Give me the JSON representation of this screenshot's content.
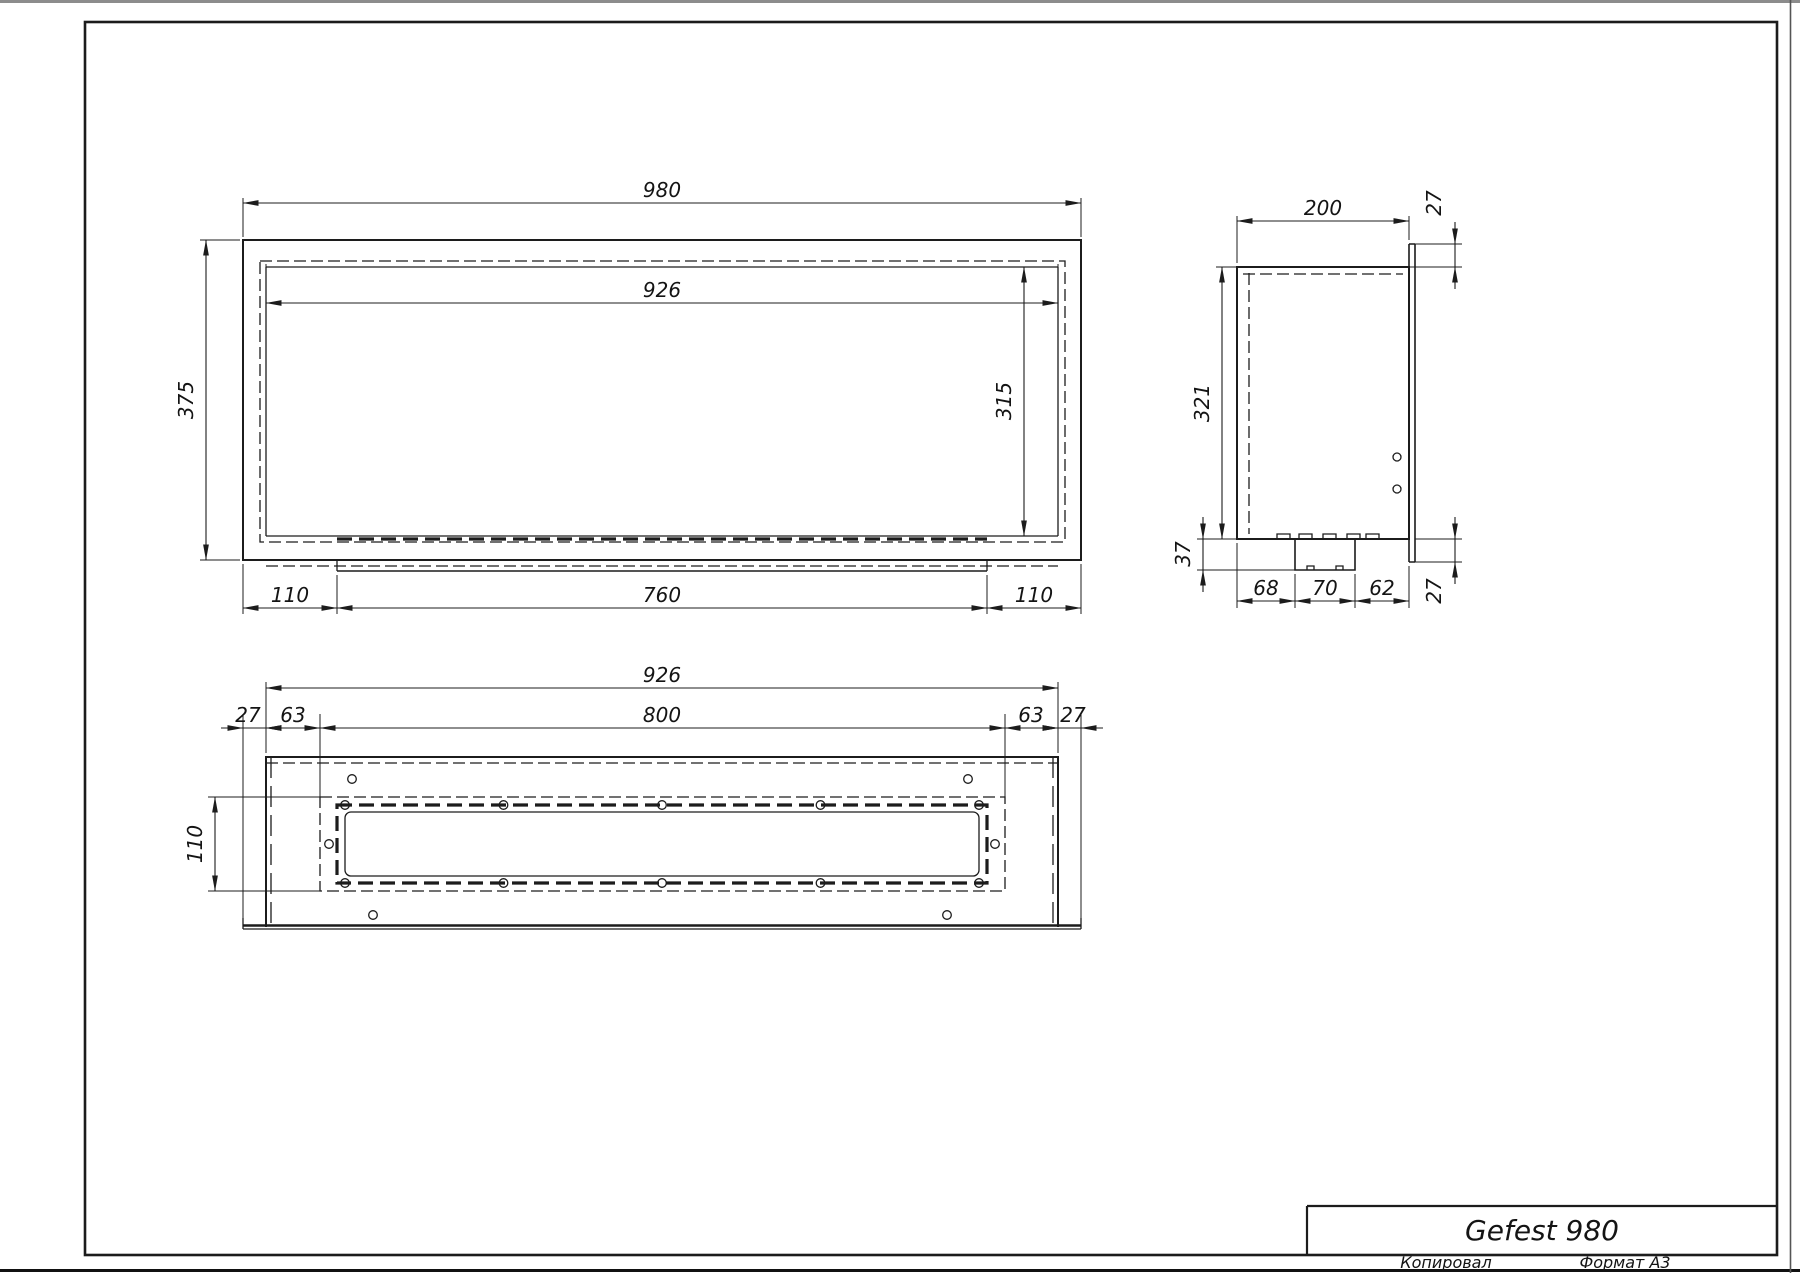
{
  "title_block": {
    "title": "Gefest 980"
  },
  "page": {
    "bottom_labels": {
      "copied": "Копировал",
      "format": "Формат А3"
    }
  },
  "front_view": {
    "name": "front view",
    "dims": {
      "overall_width": "980",
      "opening_width": "926",
      "overall_height": "375",
      "opening_height": "315",
      "bottom_left": "110",
      "tray_width": "760",
      "bottom_right": "110"
    }
  },
  "side_view": {
    "name": "side view",
    "dims": {
      "depth": "200",
      "flange_top": "27",
      "height": "321",
      "tray_depth": "37",
      "tray_offset_front": "68",
      "tray_width": "70",
      "tray_offset_back": "62",
      "flange_bottom": "27"
    }
  },
  "top_view": {
    "name": "top view",
    "dims": {
      "body_width": "926",
      "overhang_left": "27",
      "slot_offset_left": "63",
      "slot_length": "800",
      "slot_offset_right": "63",
      "overhang_right": "27",
      "slot_width": "110"
    }
  },
  "drawing": {
    "line_color": "#1c1c1c",
    "background": "#ffffff"
  }
}
